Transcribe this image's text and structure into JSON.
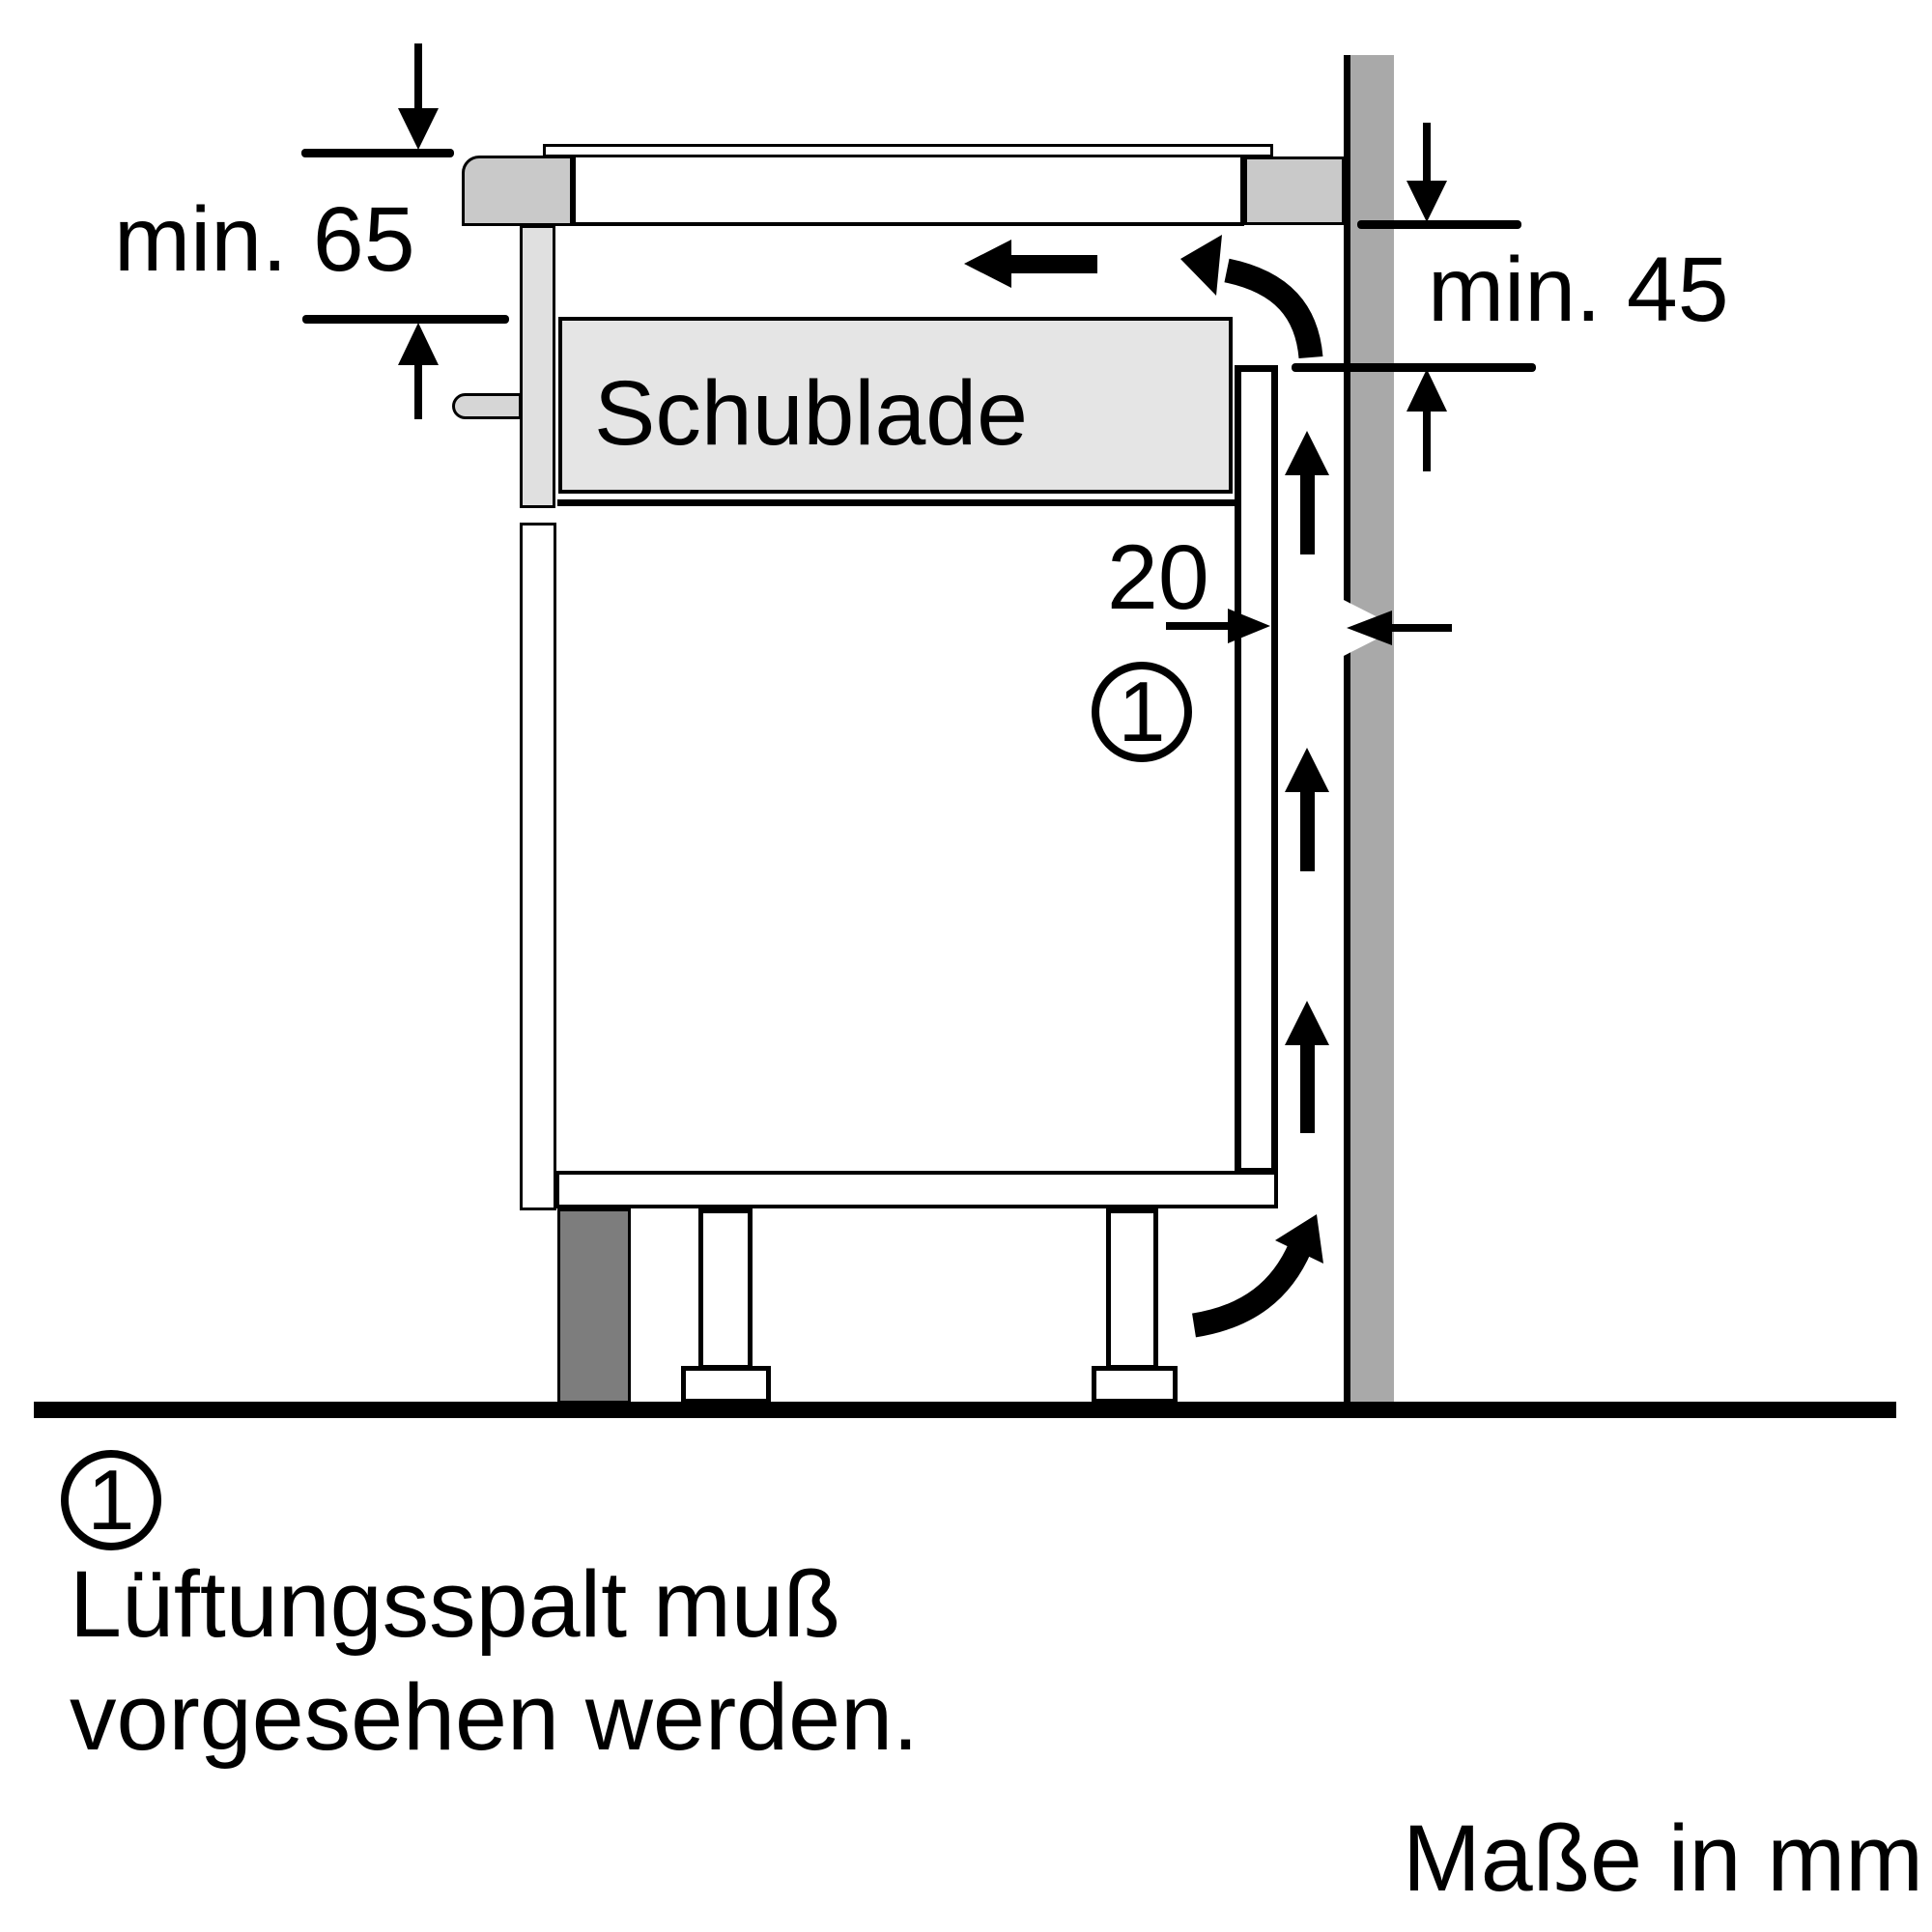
{
  "diagram": {
    "type": "appliance-installation-side-view",
    "unit_note": "Maße in mm",
    "labels": {
      "drawer": "Schublade",
      "dim_top_front": "min. 65",
      "dim_wall": "min. 45",
      "dim_gap": "20"
    },
    "callout": {
      "marker": "1"
    },
    "legend": {
      "marker": "1",
      "text_line1": "Lüftungsspalt muß",
      "text_line2": "vorgesehen werden."
    },
    "icons": {
      "airflow-up-arrow": "↑",
      "airflow-left-arrow": "←",
      "airflow-curved-arrow": "⤴",
      "dimension-arrow": "↕"
    }
  },
  "colors": {
    "line": "#000000",
    "background": "#ffffff",
    "wall": "#a9a9a9",
    "plinth": "#7d7d7d",
    "worktop-trim": "#c9c9c9",
    "hob-front": "#e0e0e0",
    "fixing-pin": "#d6d6d6",
    "drawer-fill": "#e5e5e5"
  }
}
